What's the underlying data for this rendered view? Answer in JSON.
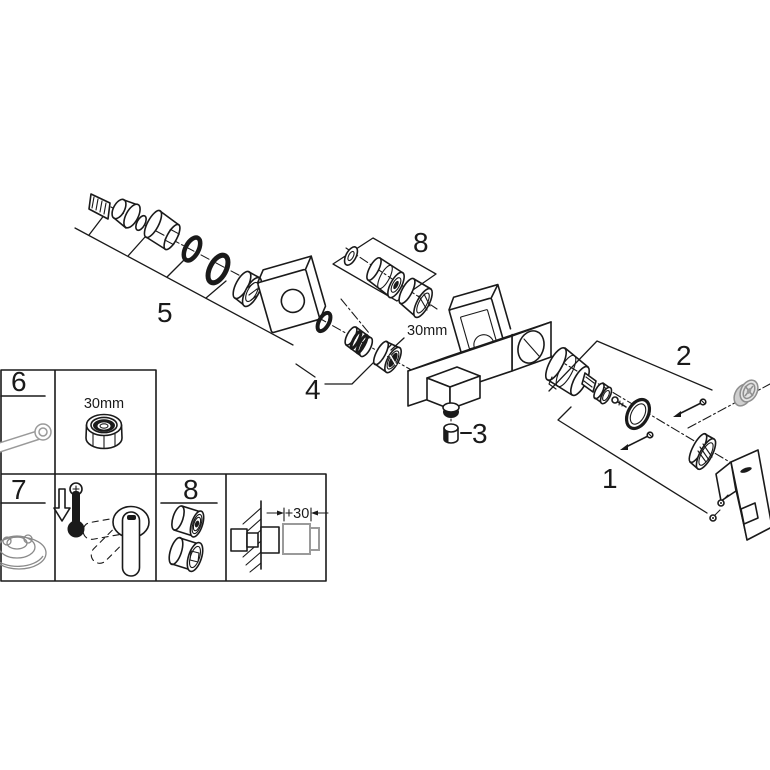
{
  "diagram": {
    "callouts": {
      "c1": "1",
      "c2": "2",
      "c3": "3",
      "c4": "4",
      "c5": "5",
      "c8": "8",
      "nut_size": "30mm"
    },
    "legend": {
      "box6_label": "6",
      "nut_box_size": "30mm",
      "box7_label": "7",
      "box8_label": "8",
      "extension_dimension": "+30"
    },
    "colors": {
      "line": "#1a1a1a",
      "muted": "#9a9a9a",
      "background": "#ffffff"
    }
  }
}
